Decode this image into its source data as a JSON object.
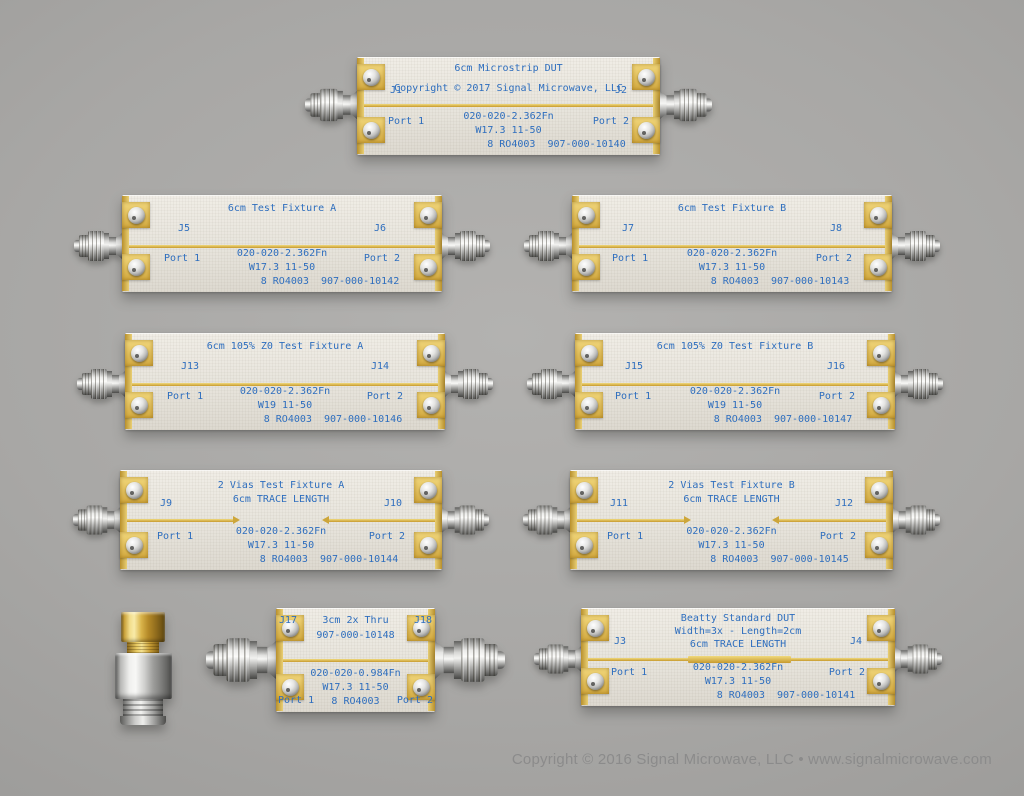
{
  "page": {
    "copyright": "Copyright © 2016 Signal Microwave, LLC • www.signalmicrowave.com"
  },
  "colors": {
    "silkscreen_blue": "#2e6ebe",
    "trace_gold": "#d4ae3c",
    "board_cream": "#e9e6df",
    "background_gray": "#a6a5a3",
    "copyright_gray": "#8b8b8b"
  },
  "boards": [
    {
      "title_lines": [
        "6cm Microstrip DUT",
        "Copyright © 2017 Signal Microwave, LLC"
      ],
      "j_left": "J1",
      "j_right": "J2",
      "port_left": "Port 1",
      "port_right": "Port 2",
      "specs": [
        "020-020-2.362Fn",
        "W17.3 11-50",
        "8 RO4003  907-000-10140"
      ]
    },
    {
      "title_lines": [
        "6cm Test Fixture A"
      ],
      "j_left": "J5",
      "j_right": "J6",
      "port_left": "Port 1",
      "port_right": "Port 2",
      "specs": [
        "020-020-2.362Fn",
        "W17.3 11-50",
        "8 RO4003  907-000-10142"
      ]
    },
    {
      "title_lines": [
        "6cm Test Fixture B"
      ],
      "j_left": "J7",
      "j_right": "J8",
      "port_left": "Port 1",
      "port_right": "Port 2",
      "specs": [
        "020-020-2.362Fn",
        "W17.3 11-50",
        "8 RO4003  907-000-10143"
      ]
    },
    {
      "title_lines": [
        "6cm 105% Z0 Test Fixture A"
      ],
      "j_left": "J13",
      "j_right": "J14",
      "port_left": "Port 1",
      "port_right": "Port 2",
      "specs": [
        "020-020-2.362Fn",
        "W19 11-50",
        "8 RO4003  907-000-10146"
      ]
    },
    {
      "title_lines": [
        "6cm 105% Z0 Test Fixture B"
      ],
      "j_left": "J15",
      "j_right": "J16",
      "port_left": "Port 1",
      "port_right": "Port 2",
      "specs": [
        "020-020-2.362Fn",
        "W19 11-50",
        "8 RO4003  907-000-10147"
      ]
    },
    {
      "title_lines": [
        "2 Vias Test Fixture A",
        "6cm TRACE LENGTH"
      ],
      "j_left": "J9",
      "j_right": "J10",
      "port_left": "Port 1",
      "port_right": "Port 2",
      "specs": [
        "020-020-2.362Fn",
        "W17.3 11-50",
        "8 RO4003  907-000-10144"
      ]
    },
    {
      "title_lines": [
        "2 Vias Test Fixture B",
        "6cm TRACE LENGTH"
      ],
      "j_left": "J11",
      "j_right": "J12",
      "port_left": "Port 1",
      "port_right": "Port 2",
      "specs": [
        "020-020-2.362Fn",
        "W17.3 11-50",
        "8 RO4003  907-000-10145"
      ]
    },
    {
      "title_lines": [
        "3cm 2x Thru",
        "907-000-10148"
      ],
      "j_left": "J17",
      "j_right": "J18",
      "port_left": "Port 1",
      "port_right": "Port 2",
      "specs": [
        "020-020-0.984Fn",
        "W17.3 11-50",
        "8 RO4003"
      ]
    },
    {
      "title_lines": [
        "Beatty Standard DUT",
        "Width=3x - Length=2cm",
        "6cm TRACE LENGTH"
      ],
      "j_left": "J3",
      "j_right": "J4",
      "port_left": "Port 1",
      "port_right": "Port 2",
      "specs": [
        "020-020-2.362Fn",
        "W17.3 11-50",
        "8 RO4003  907-000-10141"
      ]
    }
  ],
  "adapter": {
    "description": "SMA male-to-female adapter, gold and stainless, standing vertically"
  }
}
